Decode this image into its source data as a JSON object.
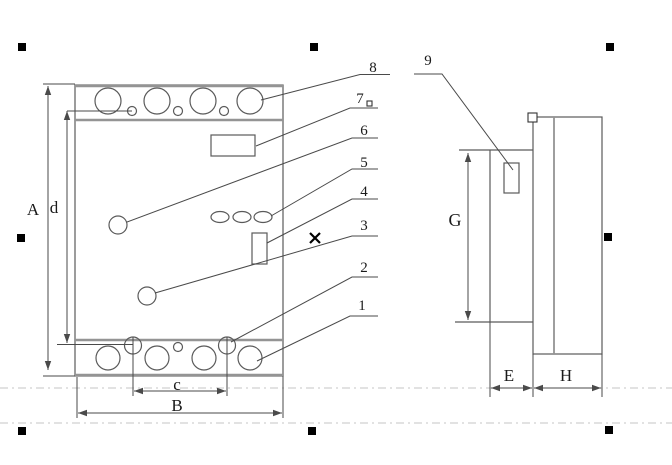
{
  "labels": {
    "A": "A",
    "d": "d",
    "c": "c",
    "B": "B",
    "G": "G",
    "E": "E",
    "H": "H"
  },
  "callouts": {
    "c1": "1",
    "c2": "2",
    "c3": "3",
    "c4": "4",
    "c5": "5",
    "c6": "6",
    "c7": "7",
    "c8": "8",
    "c9": "9"
  },
  "colors": {
    "line": "#5a5a5a",
    "thick_line": "#949494",
    "dimension": "#4a4a4a",
    "handle": "#000000",
    "guide": "#c4c4c4",
    "background": "#ffffff"
  }
}
